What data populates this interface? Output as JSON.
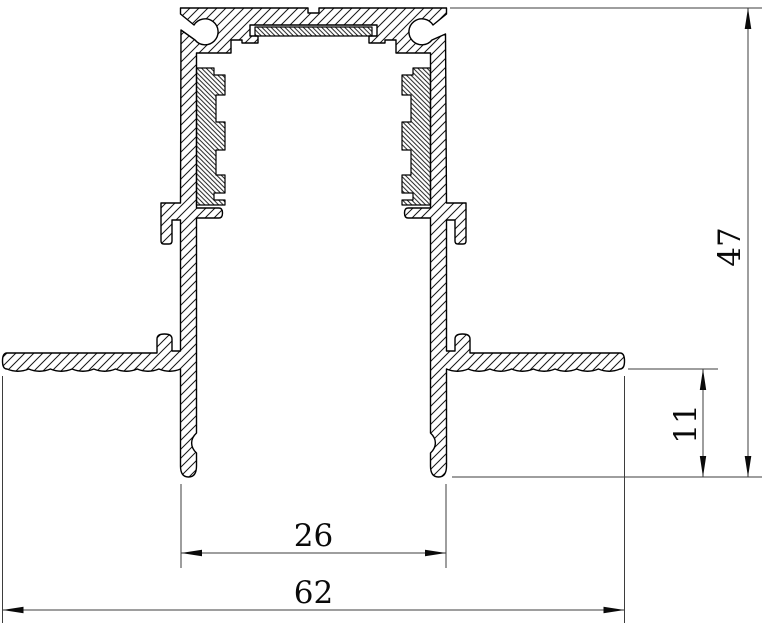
{
  "dimensions": {
    "overall_height": "47",
    "recess_below_flange": "11",
    "recess_outer_width": "26",
    "overall_width": "62"
  }
}
